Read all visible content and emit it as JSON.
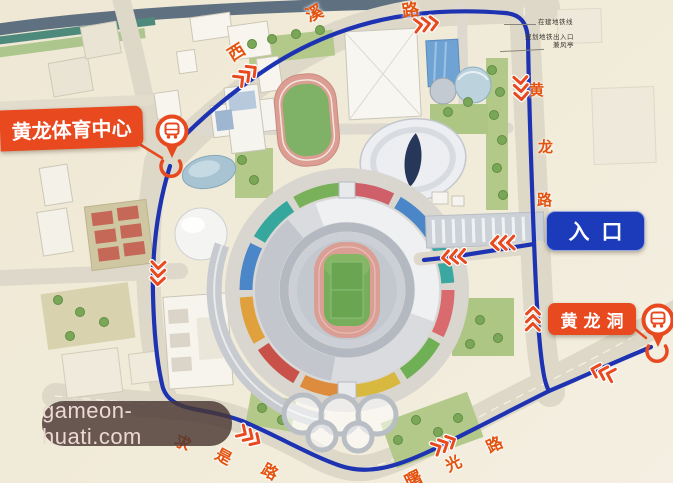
{
  "map": {
    "callouts": {
      "sports_center": "黄龙体育中心",
      "entrance": "入口",
      "cave": "黄龙洞"
    },
    "roads": {
      "xixi": {
        "name": "西溪路",
        "chars": [
          "西",
          "溪",
          "路"
        ]
      },
      "huanglong": {
        "name": "黄龙路",
        "chars": [
          "黄",
          "龙",
          "路"
        ]
      },
      "qiushi": {
        "name": "求是路",
        "chars": [
          "求",
          "是",
          "路"
        ]
      },
      "shuguang": {
        "name": "曙光路",
        "chars": [
          "曙",
          "光",
          "路"
        ]
      }
    },
    "annotations": {
      "note_1": "在建地铁线",
      "note_2": "规划地铁出入口",
      "note_3": "兼风亭"
    },
    "watermark": "gameon-huati.com",
    "icons": {
      "pin": "metro-station-pin-icon",
      "arrow": "route-direction-arrow-icon"
    },
    "colors": {
      "accent_red": "#e8491f",
      "route_blue": "#1e33b2",
      "entrance_blue": "#1c3bbb",
      "map_bg": "#f1ebd9"
    }
  }
}
